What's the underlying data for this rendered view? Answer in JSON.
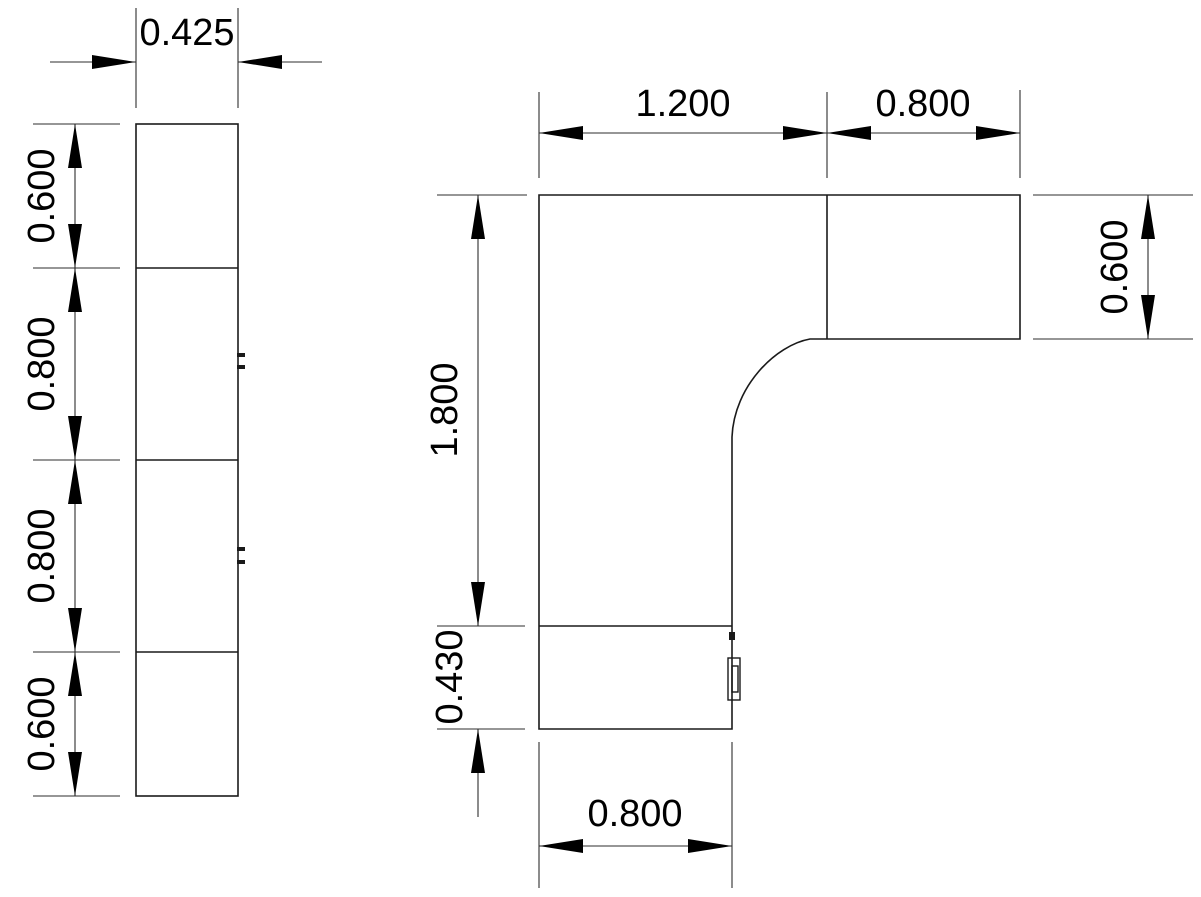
{
  "drawing": {
    "background_color": "#ffffff",
    "line_color": "#1a1a1a",
    "dimension_color": "#000000",
    "side_view": {
      "width": "0.425",
      "segments": [
        "0.600",
        "0.800",
        "0.800",
        "0.600"
      ]
    },
    "plan_view": {
      "top_segments": [
        "1.200",
        "0.800"
      ],
      "left_height": "1.800",
      "right_depth": "0.600",
      "return_depth": "0.430",
      "bottom_width": "0.800"
    }
  }
}
